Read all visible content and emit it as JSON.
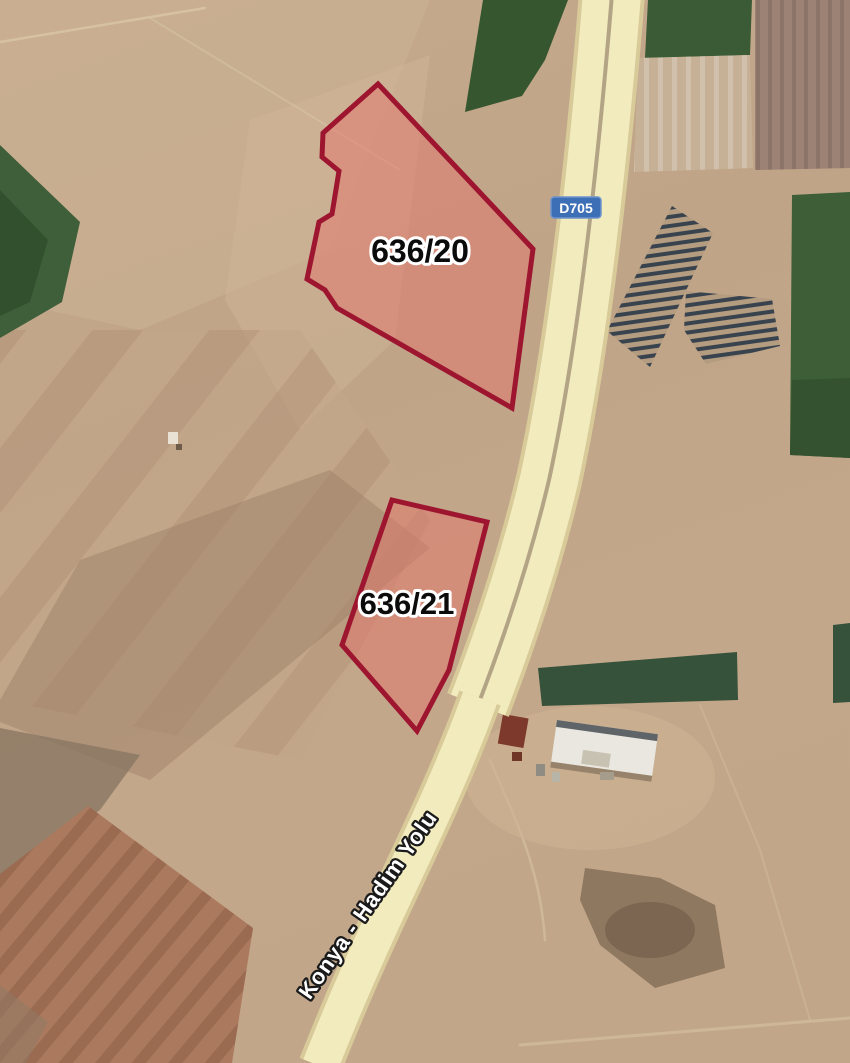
{
  "map": {
    "road": {
      "shield_label": "D705",
      "name_label": "Konya - Hadim Yolu"
    },
    "parcels": [
      {
        "id": "636/20",
        "points": "378,84 533,249 512,408 337,308 325,290 307,279 319,222 332,214 339,171 322,157 323,133"
      },
      {
        "id": "636/21",
        "points": "392,500 487,522 449,670 417,731 342,645"
      }
    ],
    "colors": {
      "parcel_fill": "rgba(228,118,108,0.5)",
      "parcel_stroke": "#9e1530",
      "road_fill": "#f1ebbe",
      "road_casing": "#d8ca99",
      "shield_bg": "#3d6fb7",
      "shield_border": "#6e93cc",
      "shield_text": "#ffffff",
      "ground_tan": "#c2a68a",
      "field_green": "#3d5e37",
      "plowed_red": "#ab7a5e"
    }
  }
}
